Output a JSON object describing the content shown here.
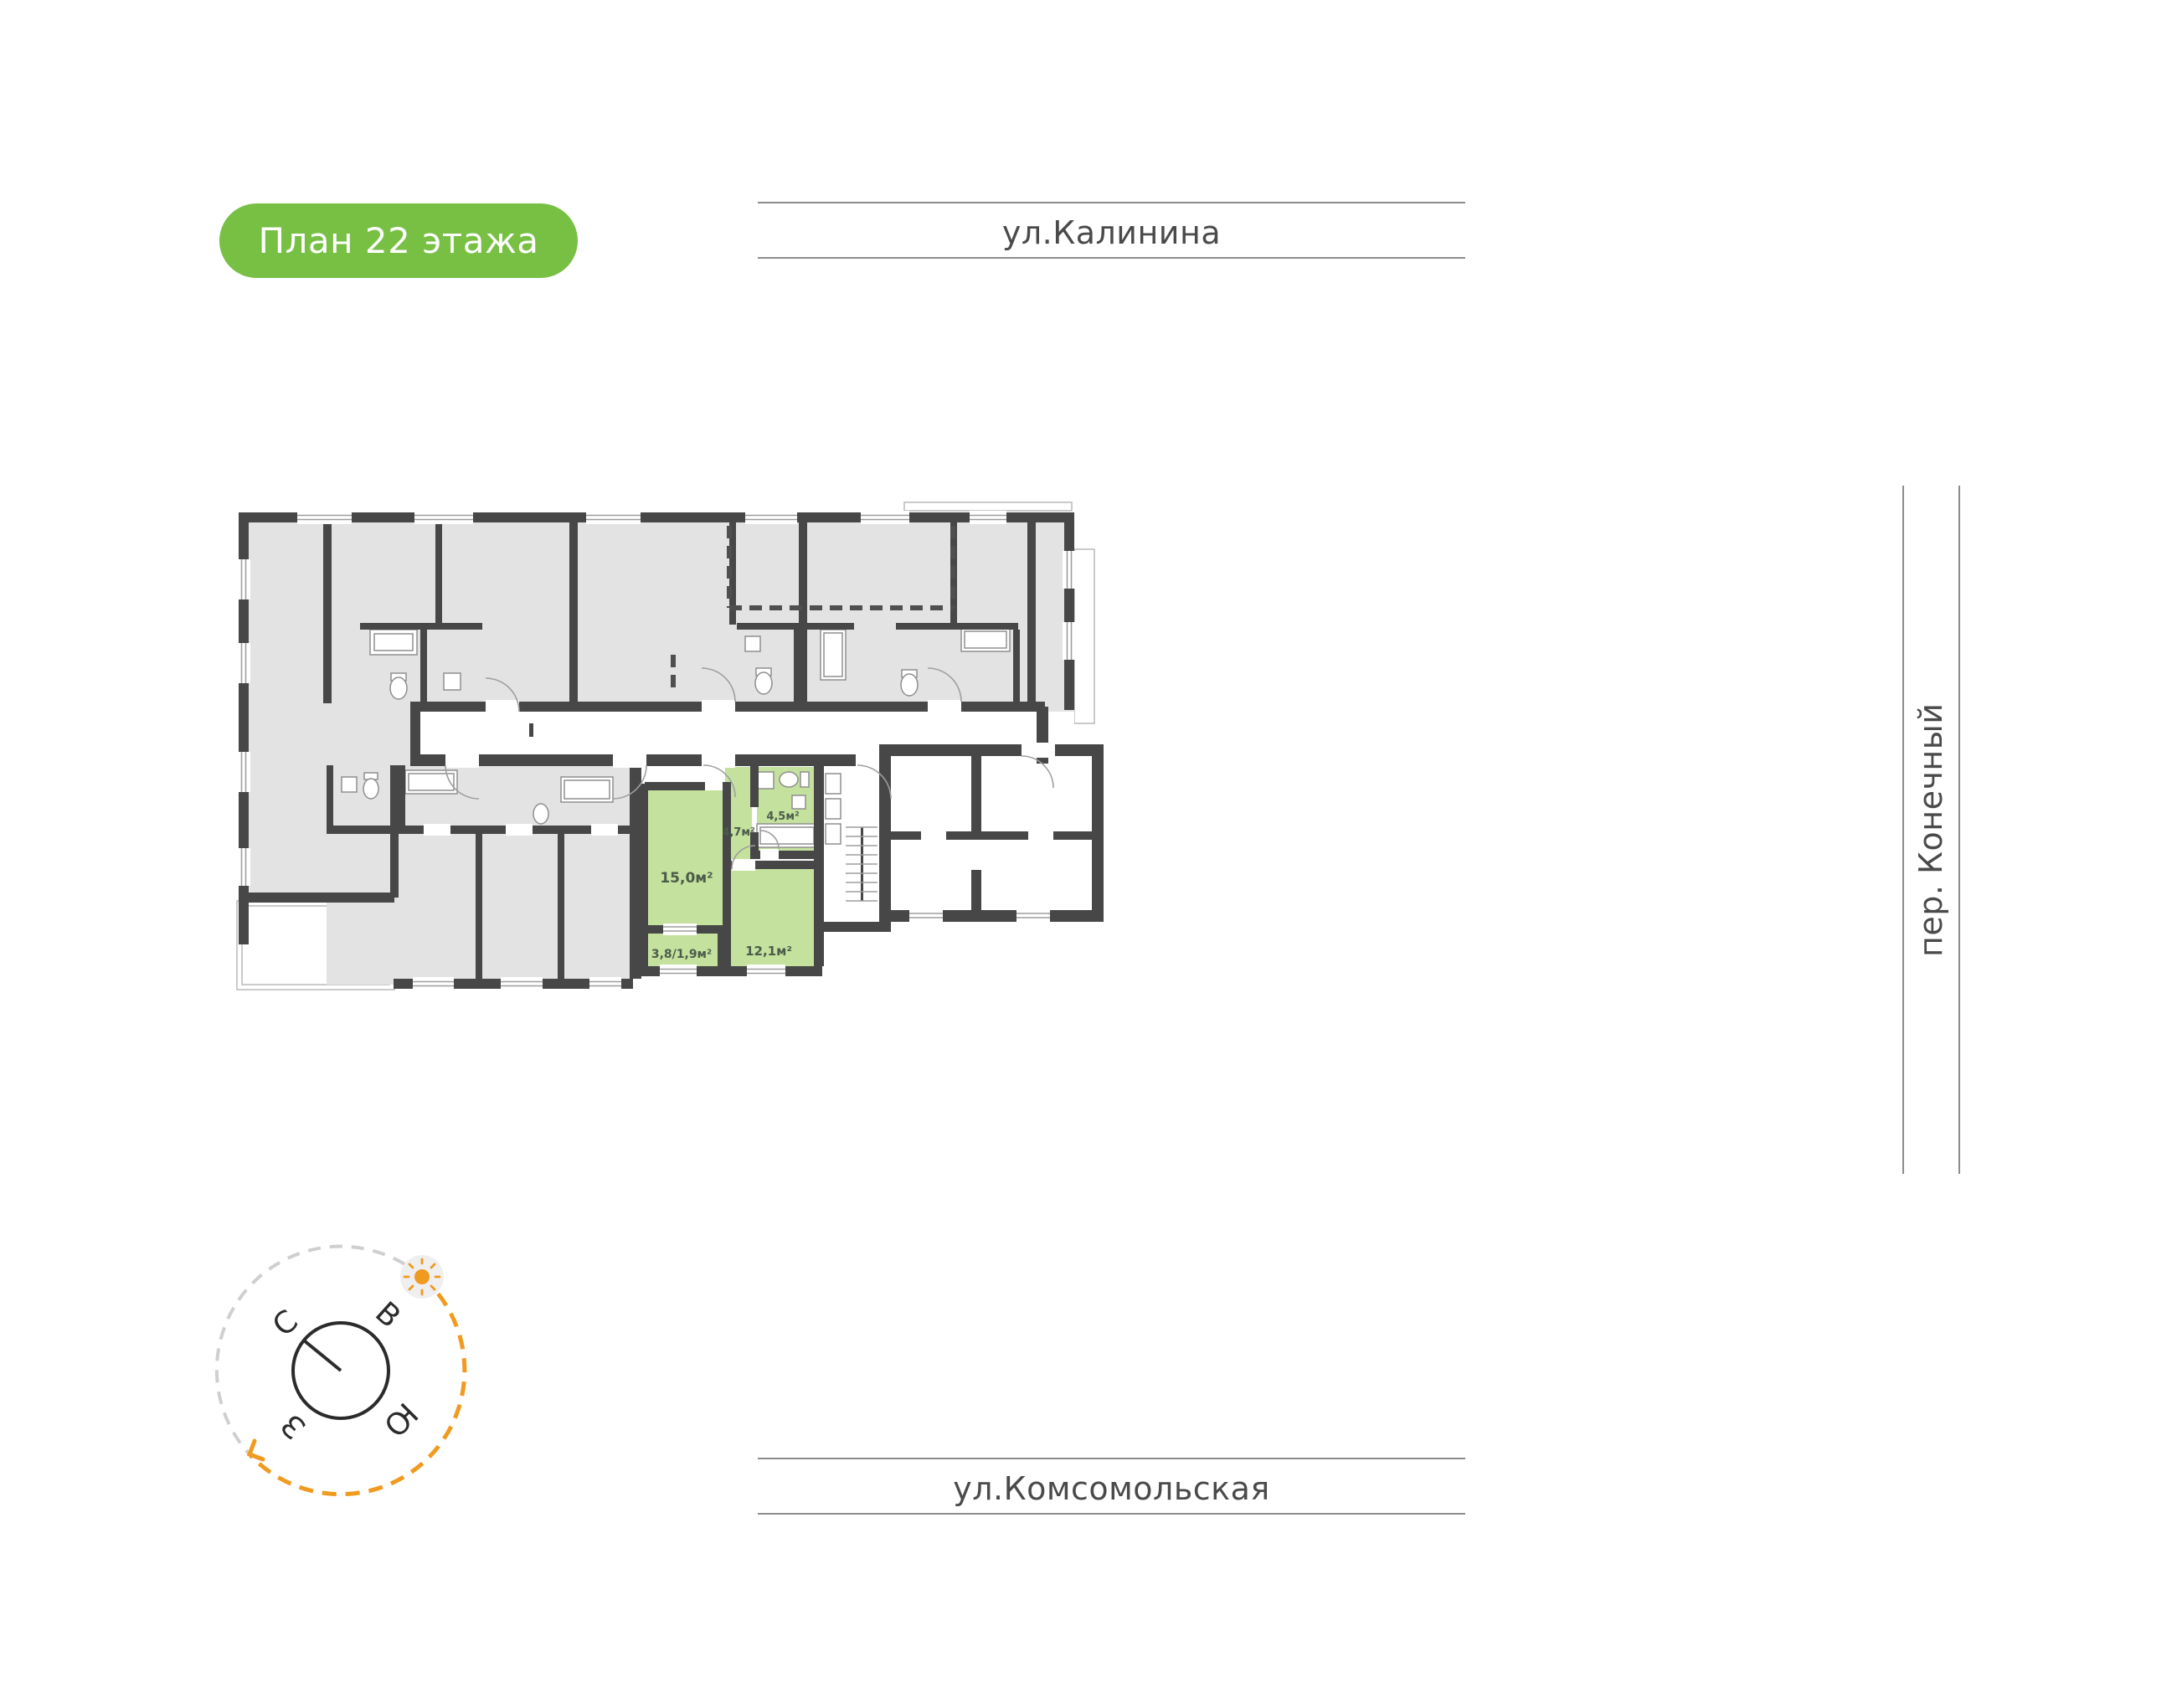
{
  "badge": {
    "label": "План 22 этажа",
    "bg": "#77C044",
    "text_color": "#FFFFFF"
  },
  "streets": {
    "top": {
      "label": "ул.Калинина"
    },
    "right": {
      "label": "пер. Конечный"
    },
    "bottom": {
      "label": "ул.Комсомольская"
    },
    "text_color": "#4A4A4A",
    "line_color": "#8C8C8C"
  },
  "compass": {
    "north": "С",
    "east": "В",
    "south": "Ю",
    "west": "З",
    "needle_color": "#2B2B2B",
    "sun_color": "#F09A1F",
    "arc_gray": "#CFCFCF",
    "arc_orange": "#F09A1F",
    "sun_badge_bg": "#EFEFEF"
  },
  "floorplan": {
    "colors": {
      "wall": "#474747",
      "room_fill": "#E3E3E3",
      "highlight_fill": "#C4E19E",
      "label": "#4C5B4A",
      "thin_line": "#9E9E9E"
    },
    "highlighted_apartment": {
      "rooms": [
        {
          "name": "living-room",
          "area_label": "15,0м²"
        },
        {
          "name": "hallway",
          "area_label": "4,7м²"
        },
        {
          "name": "bathroom",
          "area_label": "4,5м²"
        },
        {
          "name": "bedroom",
          "area_label": "12,1м²"
        },
        {
          "name": "balcony",
          "area_label": "3,8/1,9м²"
        }
      ]
    }
  }
}
